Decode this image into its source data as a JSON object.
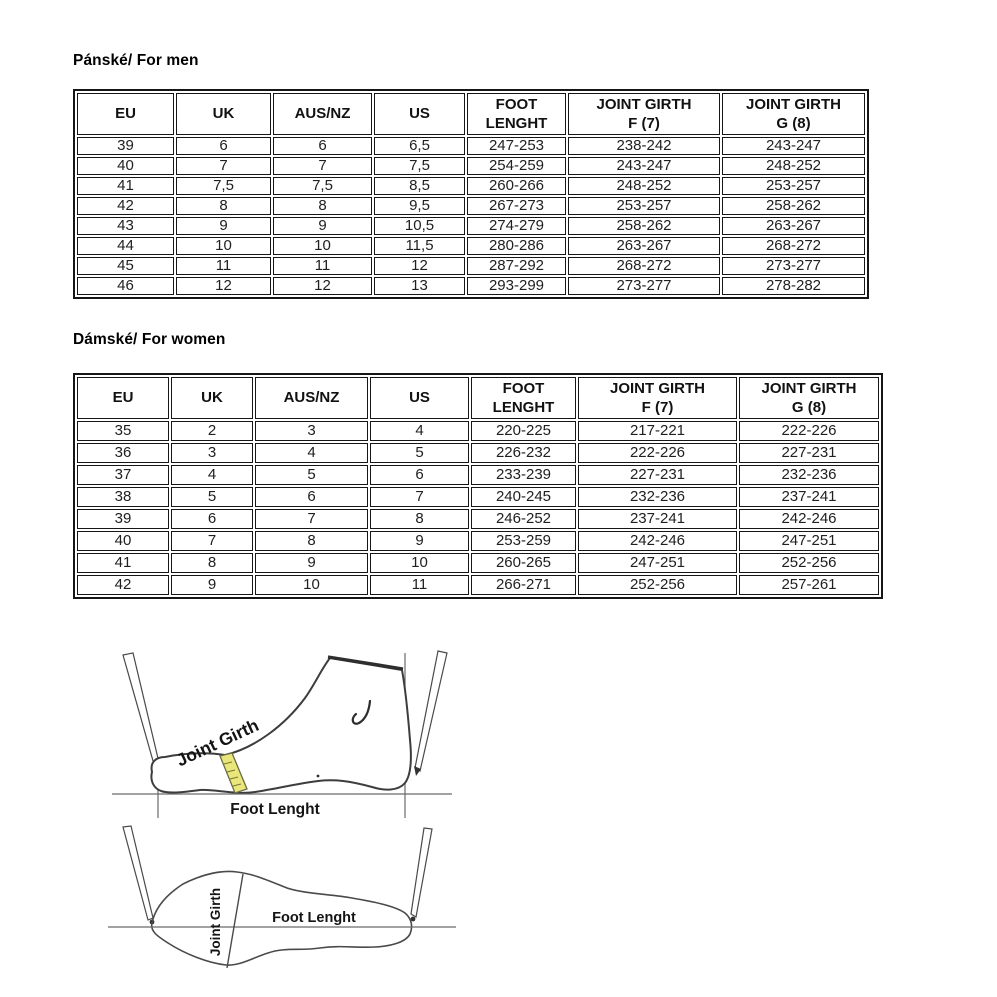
{
  "sections": {
    "men": {
      "title": "Pánské/ For men"
    },
    "women": {
      "title": "Dámské/ For women"
    }
  },
  "tables": {
    "men": {
      "headers": [
        "EU",
        "UK",
        "AUS/NZ",
        "US",
        "FOOT\nLENGHT",
        "JOINT GIRTH\nF (7)",
        "JOINT GIRTH\nG (8)"
      ],
      "rows": [
        [
          "39",
          "6",
          "6",
          "6,5",
          "247-253",
          "238-242",
          "243-247"
        ],
        [
          "40",
          "7",
          "7",
          "7,5",
          "254-259",
          "243-247",
          "248-252"
        ],
        [
          "41",
          "7,5",
          "7,5",
          "8,5",
          "260-266",
          "248-252",
          "253-257"
        ],
        [
          "42",
          "8",
          "8",
          "9,5",
          "267-273",
          "253-257",
          "258-262"
        ],
        [
          "43",
          "9",
          "9",
          "10,5",
          "274-279",
          "258-262",
          "263-267"
        ],
        [
          "44",
          "10",
          "10",
          "11,5",
          "280-286",
          "263-267",
          "268-272"
        ],
        [
          "45",
          "11",
          "11",
          "12",
          "287-292",
          "268-272",
          "273-277"
        ],
        [
          "46",
          "12",
          "12",
          "13",
          "293-299",
          "273-277",
          "278-282"
        ]
      ]
    },
    "women": {
      "headers": [
        "EU",
        "UK",
        "AUS/NZ",
        "US",
        "FOOT\nLENGHT",
        "JOINT GIRTH\nF (7)",
        "JOINT GIRTH\nG (8)"
      ],
      "rows": [
        [
          "35",
          "2",
          "3",
          "4",
          "220-225",
          "217-221",
          "222-226"
        ],
        [
          "36",
          "3",
          "4",
          "5",
          "226-232",
          "222-226",
          "227-231"
        ],
        [
          "37",
          "4",
          "5",
          "6",
          "233-239",
          "227-231",
          "232-236"
        ],
        [
          "38",
          "5",
          "6",
          "7",
          "240-245",
          "232-236",
          "237-241"
        ],
        [
          "39",
          "6",
          "7",
          "8",
          "246-252",
          "237-241",
          "242-246"
        ],
        [
          "40",
          "7",
          "8",
          "9",
          "253-259",
          "242-246",
          "247-251"
        ],
        [
          "41",
          "8",
          "9",
          "10",
          "260-265",
          "247-251",
          "252-256"
        ],
        [
          "42",
          "9",
          "10",
          "11",
          "266-271",
          "252-256",
          "257-261"
        ]
      ]
    }
  },
  "diagrams": {
    "side_view": {
      "joint_girth": "Joint Girth",
      "foot_length": "Foot Lenght"
    },
    "top_view": {
      "joint_girth": "Joint Girth",
      "foot_length": "Foot Lenght"
    }
  },
  "colors": {
    "table_border": "#161616",
    "text": "#1b1b1b",
    "tape_fill": "#e9e77b",
    "line_art": "#3d3d3d"
  }
}
